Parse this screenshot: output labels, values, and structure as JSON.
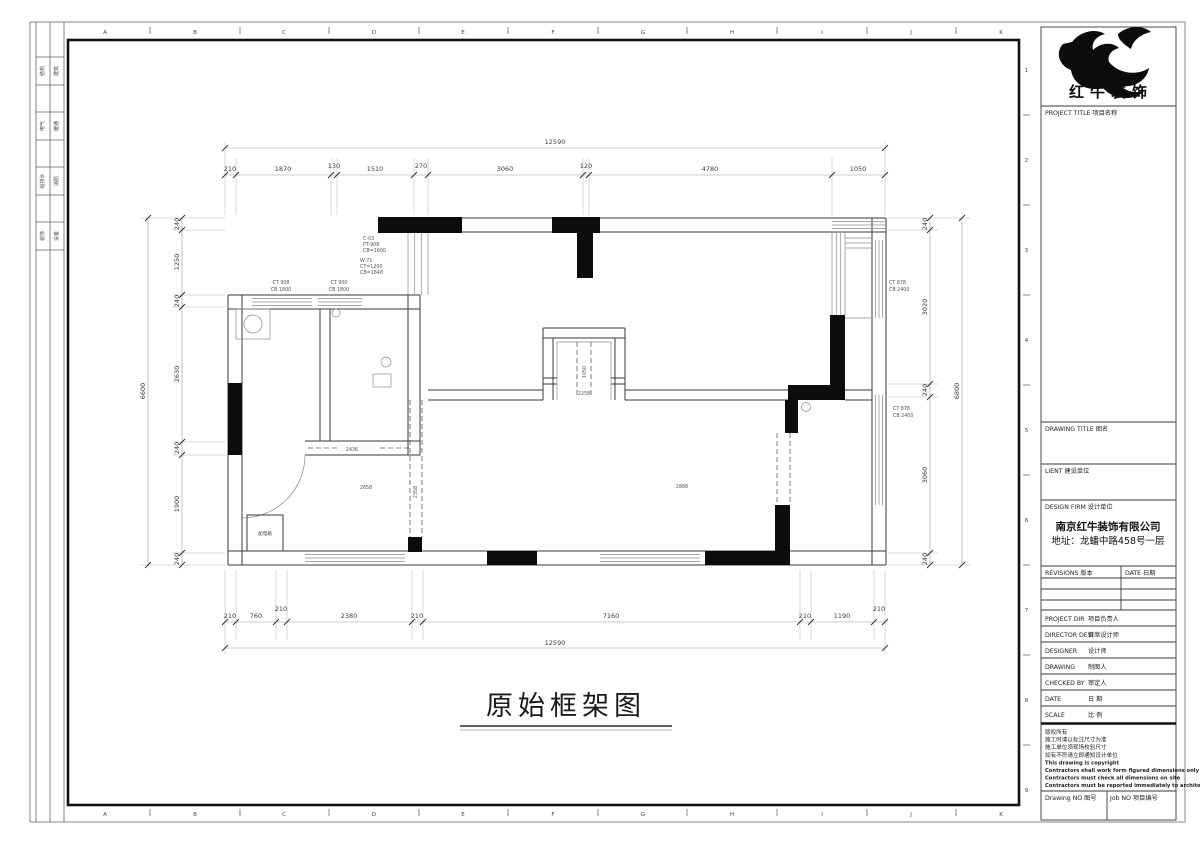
{
  "drawing": {
    "title": "原始框架图"
  },
  "brand": {
    "name": "红牛装饰"
  },
  "titleblock": {
    "project_title": "PROJECT TITLE  项目名称",
    "drawing_title": "DRAWING TITLE  图名",
    "client": "LIENT  建设单位",
    "design_firm": "DESIGN FIRM  设计单位",
    "company": "南京红牛装饰有限公司",
    "address": "地址：龙蟠中路458号一层",
    "revisions": "REVISIONS  版本",
    "date_col": "DATE  日期",
    "rows": [
      {
        "en": "PROJECT DIR",
        "cn": "项目负责人"
      },
      {
        "en": "DIRECTOR DESI",
        "cn": "首席设计师"
      },
      {
        "en": "DESIGNER",
        "cn": "设计师"
      },
      {
        "en": "DRAWING",
        "cn": "制图人"
      },
      {
        "en": "CHECKED BY",
        "cn": "审定人"
      },
      {
        "en": "DATE",
        "cn": "日  期"
      },
      {
        "en": "SCALE",
        "cn": "比  例"
      }
    ],
    "copyright": [
      "版权所有",
      "施工时请以标注尺寸为准",
      "施工单位须现场校验尺寸",
      "如有不符请立即通知设计单位",
      "This drawing is copyright",
      "Contractors shall work form figured dimensions only",
      "Contractors must check all dimensions on site",
      "Contractors must be reported immediately to architects"
    ],
    "drawing_no": "Drawing NO  图号",
    "job_no": "Job NO  项目编号"
  },
  "rulers": {
    "letters": [
      "A",
      "B",
      "C",
      "D",
      "E",
      "F",
      "G",
      "H",
      "I",
      "J",
      "K"
    ],
    "numbers": [
      "1",
      "2",
      "3",
      "4",
      "5",
      "6",
      "7",
      "8",
      "9"
    ]
  },
  "signoff": [
    [
      "结构",
      "建筑"
    ],
    [
      "电气",
      "暖通"
    ],
    [
      "给排水",
      "消防"
    ],
    [
      "装饰",
      "设备"
    ]
  ],
  "dims": {
    "top_overall": "12590",
    "top_row": [
      "210",
      "1870",
      "130",
      "1510",
      "270",
      "3060",
      "120",
      "4780",
      "1050"
    ],
    "bottom_row": [
      "210",
      "760",
      "210",
      "2380",
      "210",
      "7160",
      "210",
      "1190",
      "210"
    ],
    "bottom_overall": "12590",
    "left_col": [
      "240",
      "1250",
      "240",
      "2630",
      "240",
      "1900",
      "240"
    ],
    "left_overall": "6600",
    "right_col": [
      "240",
      "3020",
      "240",
      "3060",
      "240"
    ],
    "right_overall": "6800"
  },
  "plan": {
    "win1a": "CT 908",
    "win1b": "CB 1800",
    "win2a": "CT 900",
    "win2b": "CB 1800",
    "annoA": [
      "C-03",
      "PT-908",
      "CB=1600"
    ],
    "annoB": [
      "W-71",
      "CT=1200",
      "CB=1848"
    ],
    "annoR1": [
      "CT 878",
      "CB 2400"
    ],
    "annoR2": [
      "CT 878",
      "CB 2400"
    ],
    "shaft_v": "1050",
    "shaft_h": "2258",
    "dash_label": "2358",
    "corridor": "2658",
    "hall": "2436",
    "living": "2868",
    "box": "配电箱"
  }
}
